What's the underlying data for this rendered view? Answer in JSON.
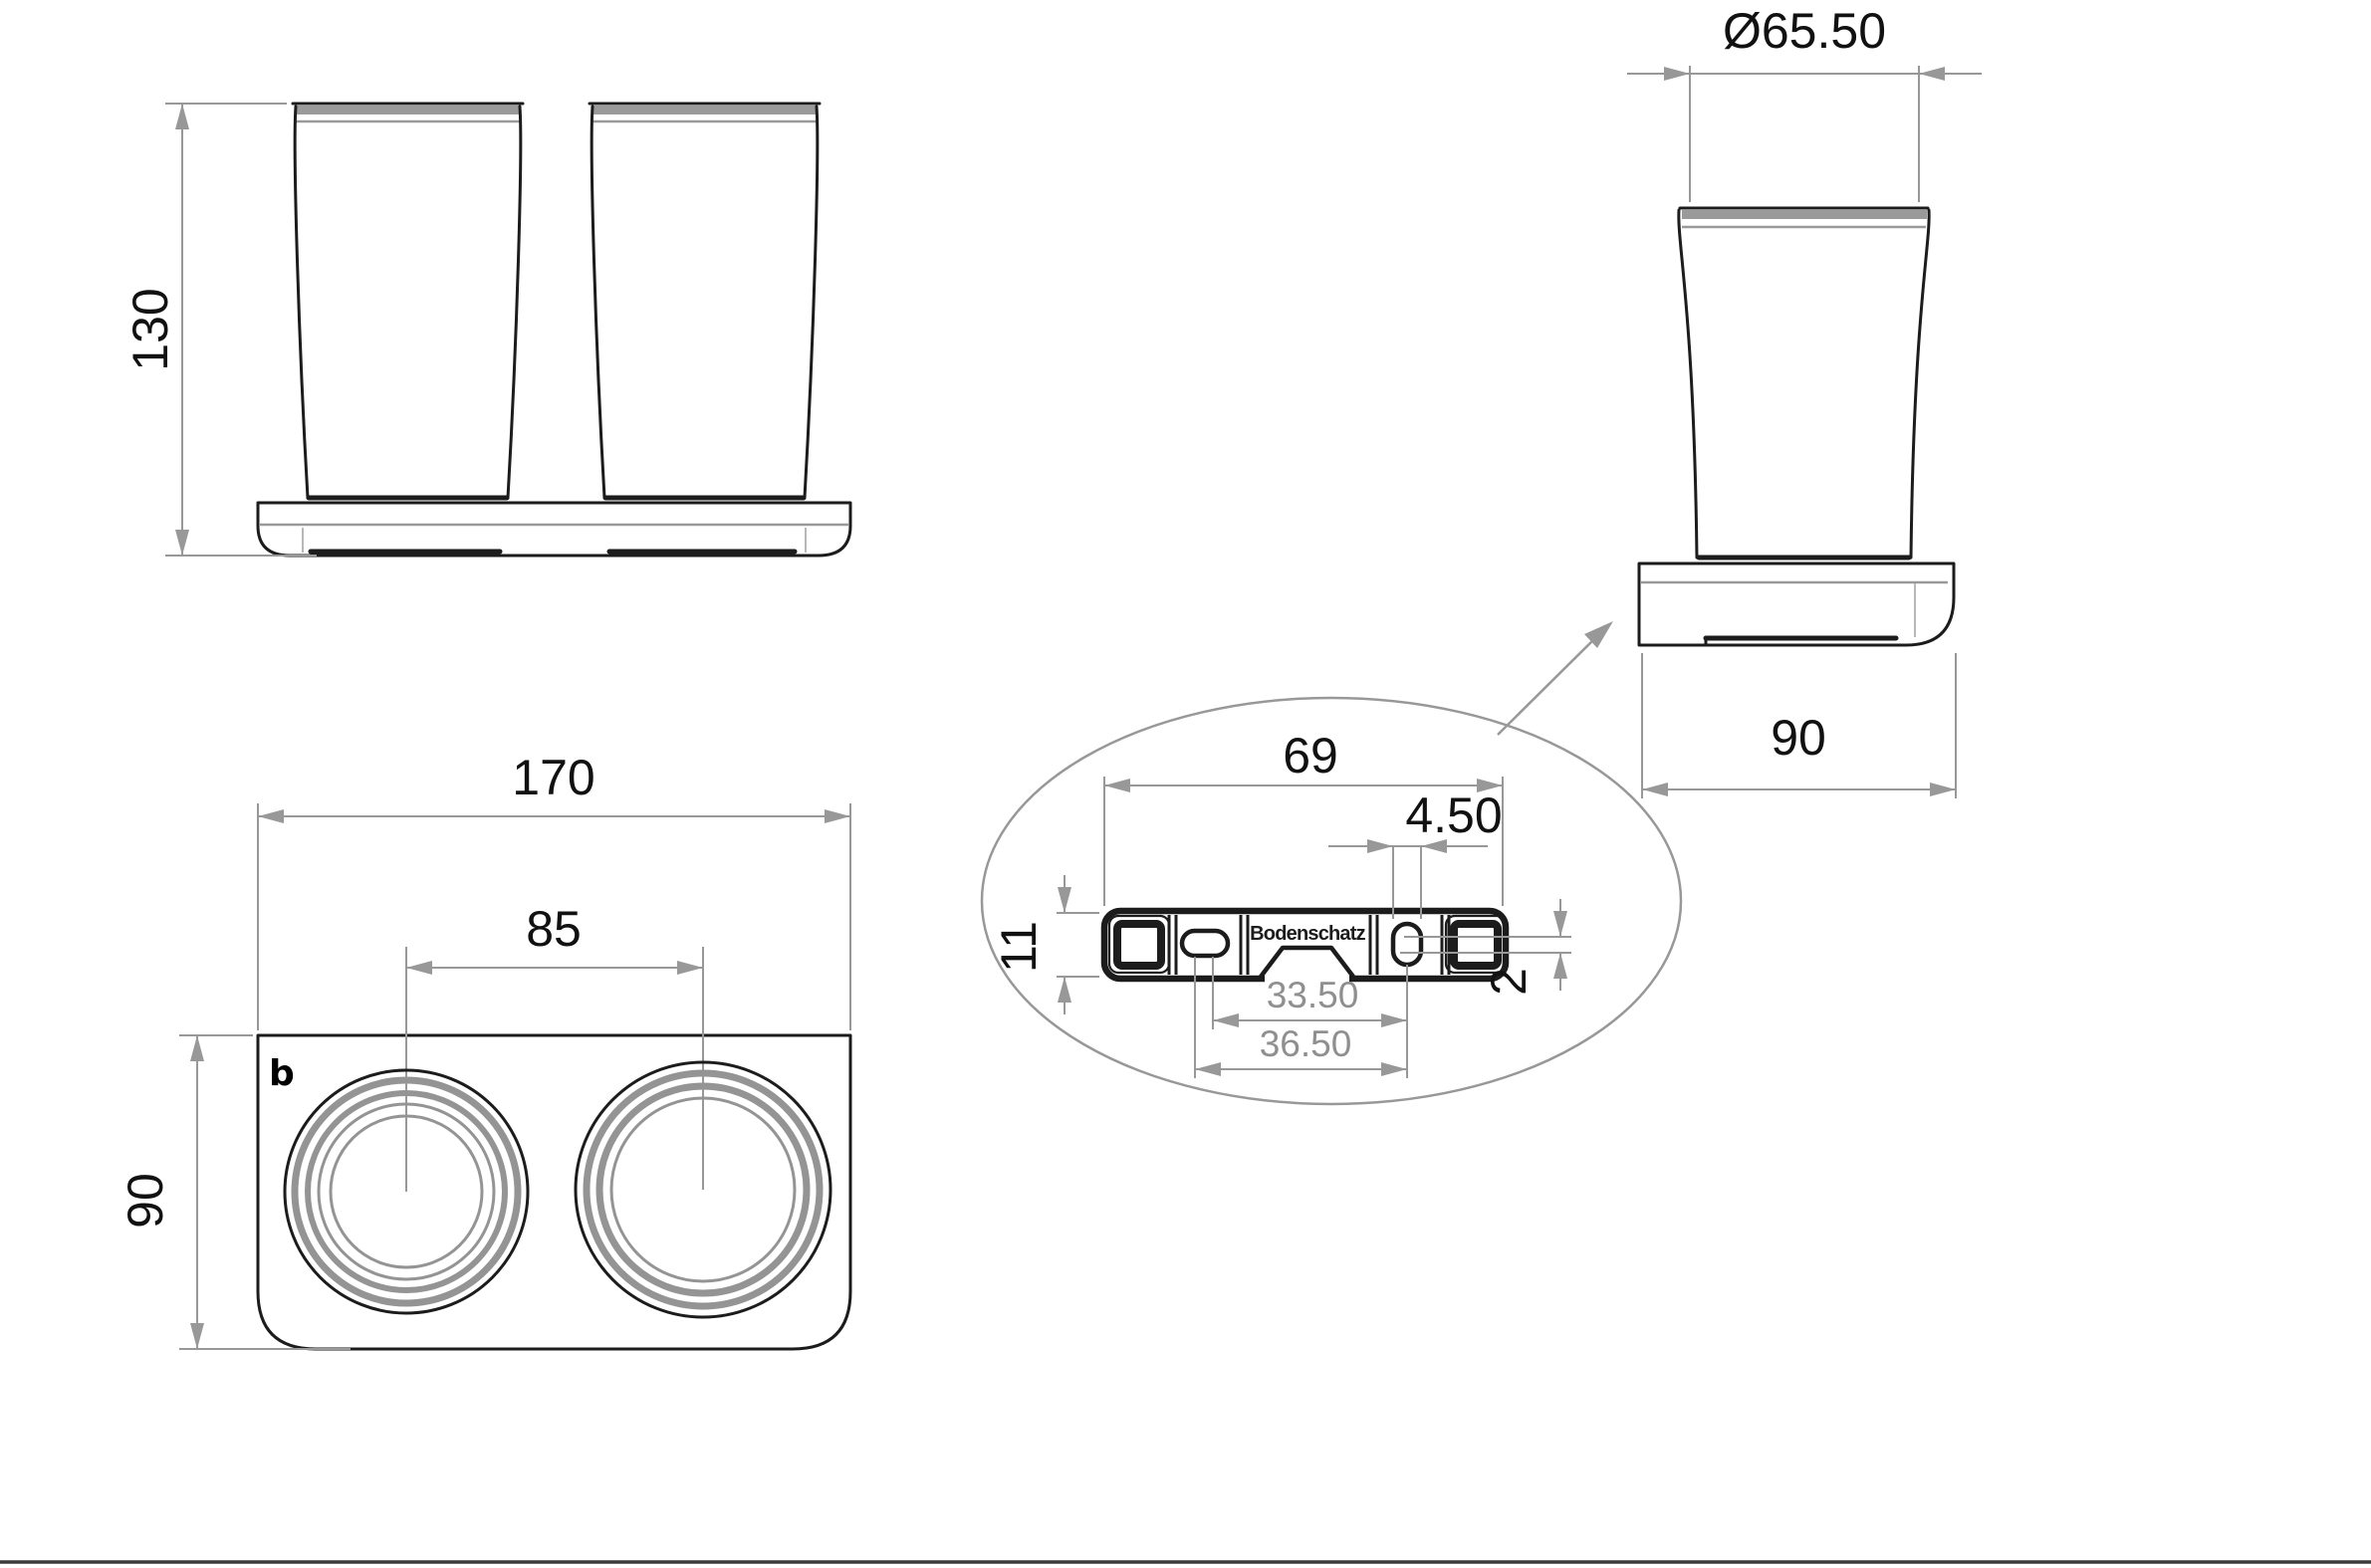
{
  "colors": {
    "ink": "#1c1c1c",
    "dim": "#989898",
    "ring": "#949494",
    "gband": "#9a9a9a",
    "text_ink": "#111111",
    "text_gray": "#8f8f8f",
    "footer": "#3b3b3b"
  },
  "drawing": {
    "brand_label": "Bodenschatz",
    "logo_glyph": "b",
    "views": {
      "front": {
        "height_dim": "130"
      },
      "side": {
        "diameter_dim": "Ø65.50",
        "depth_dim": "90"
      },
      "top": {
        "width_dim": "170",
        "cup_spacing_dim": "85",
        "depth_dim": "90"
      },
      "detail": {
        "plate_length_dim": "69",
        "slot_width_dim": "4.50",
        "plate_height_dim": "11",
        "offset_dim": "2",
        "hole_distance_inner": "33.50",
        "hole_distance_outer": "36.50"
      }
    }
  }
}
